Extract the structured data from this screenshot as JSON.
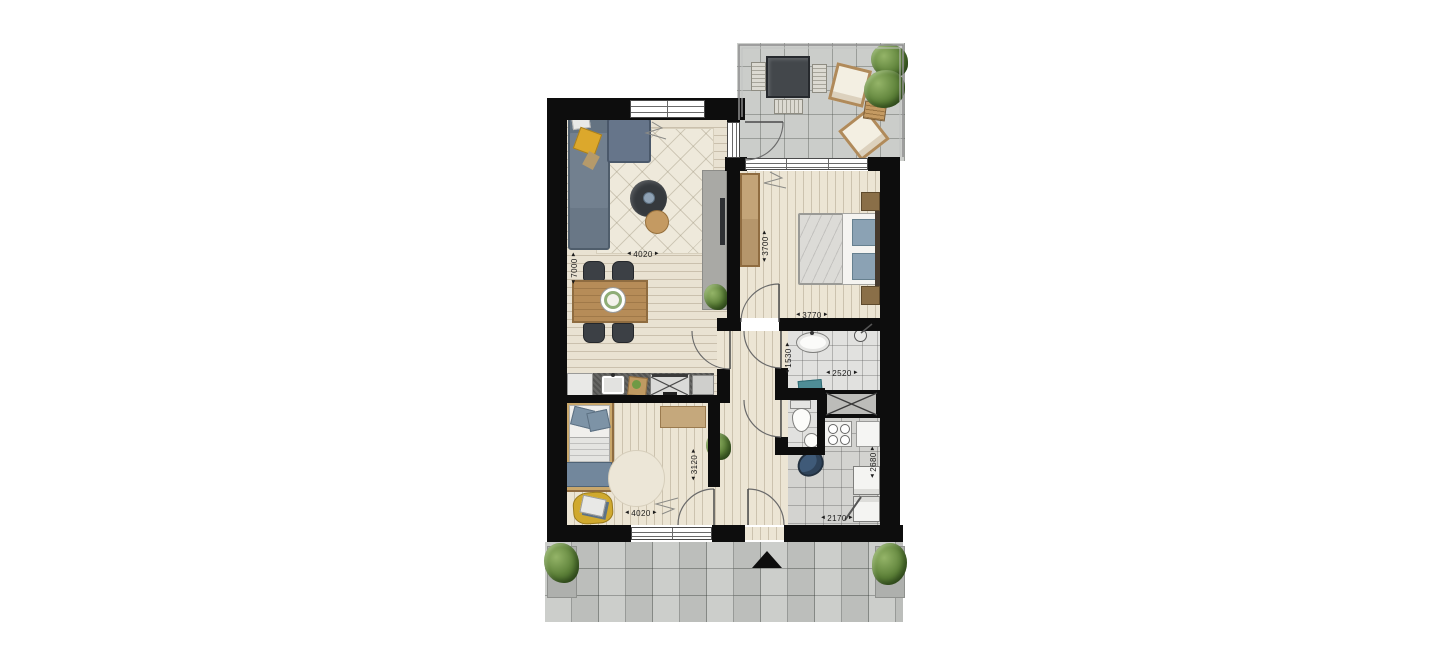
{
  "ui": {
    "arrow_left": "◄",
    "arrow_right": "►"
  },
  "floorplan": {
    "type": "apartment-floor-plan-top-view",
    "dimension_labels": [
      {
        "id": "living-room-depth",
        "value": "7000",
        "orientation": "vertical"
      },
      {
        "id": "living-room-width",
        "value": "4020",
        "orientation": "horizontal"
      },
      {
        "id": "bedroom1-depth",
        "value": "3700",
        "orientation": "vertical"
      },
      {
        "id": "bedroom1-width",
        "value": "3770",
        "orientation": "horizontal"
      },
      {
        "id": "bathroom-depth",
        "value": "1530",
        "orientation": "vertical"
      },
      {
        "id": "bathroom-width",
        "value": "2520",
        "orientation": "horizontal"
      },
      {
        "id": "bedroom2-depth",
        "value": "3120",
        "orientation": "vertical"
      },
      {
        "id": "bedroom2-width",
        "value": "4020",
        "orientation": "horizontal"
      },
      {
        "id": "storage-depth",
        "value": "2680",
        "orientation": "vertical"
      },
      {
        "id": "storage-width",
        "value": "2170",
        "orientation": "horizontal"
      }
    ],
    "rooms": [
      {
        "name": "living-dining-kitchen",
        "depth_mm": "7000",
        "width_mm": "4020"
      },
      {
        "name": "bedroom-1",
        "depth_mm": "3700",
        "width_mm": "3770"
      },
      {
        "name": "bathroom",
        "depth_mm": "1530",
        "width_mm": "2520"
      },
      {
        "name": "bedroom-2",
        "depth_mm": "3120",
        "width_mm": "4020"
      },
      {
        "name": "storage-utility",
        "depth_mm": "2680",
        "width_mm": "2170"
      },
      {
        "name": "toilet"
      },
      {
        "name": "hall"
      },
      {
        "name": "balcony"
      },
      {
        "name": "gallery-walkway"
      }
    ],
    "markers": {
      "entrance_marker": "black-triangle"
    },
    "colors": {
      "wall": "#0d0d0d",
      "wood_floor": "#e9e2d2",
      "balcony_tile": "#cbcdca",
      "gallery_tile": "#c6c8c5",
      "bathroom_tile": "#e1e1df",
      "utility_tile": "#d3d3d0",
      "sofa": "#72808f",
      "accent_pillow": "#dca82c",
      "bed_pillow": "#8ba2b4",
      "wood_furniture": "#b68c58",
      "dark_furniture": "#3c4045",
      "plant": "#5c8038"
    }
  }
}
